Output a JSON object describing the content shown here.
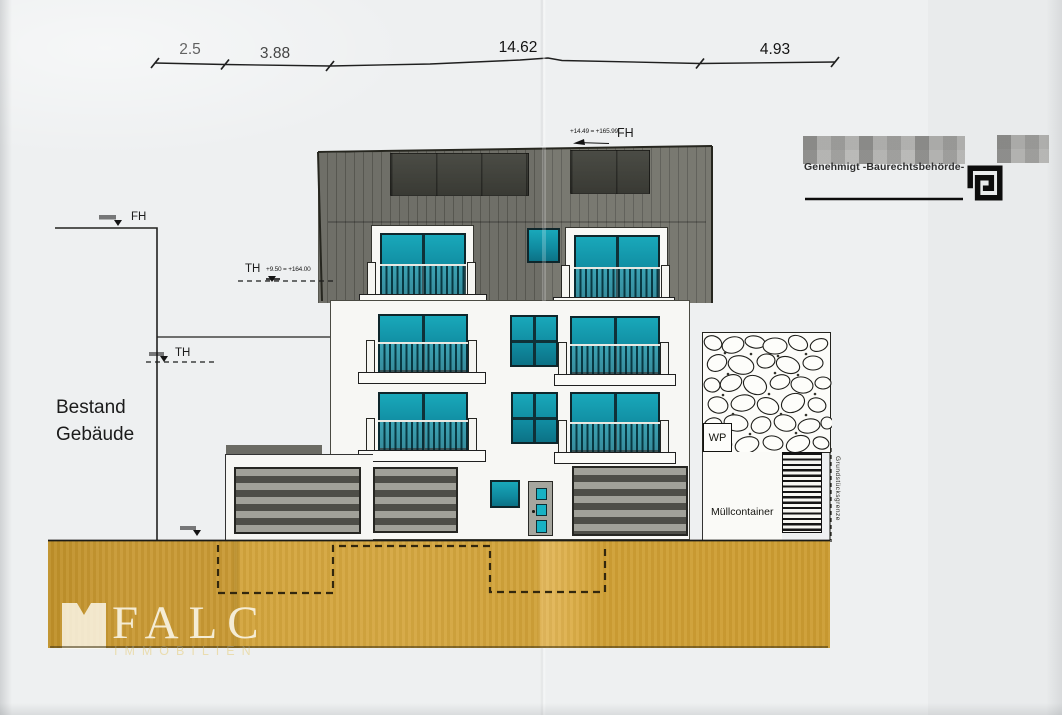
{
  "dims": [
    "2.5",
    "3.88",
    "14.62",
    "4.93"
  ],
  "levels": {
    "fh_roof": {
      "label": "FH",
      "value": "+14.49 = +165.99"
    },
    "th_upper": {
      "label": "TH",
      "value": "+9.50 = +164.00"
    },
    "fh_existing": {
      "label": "FH"
    },
    "th_existing": {
      "label": "TH"
    }
  },
  "labels": {
    "existing_building_line1": "Bestand",
    "existing_building_line2": "Gebäude",
    "wp": "WP",
    "muellcontainer": "Müllcontainer",
    "property_boundary": "Grundstücksgrenze",
    "approval": "Genehmigt -Baurechtsbehörde-"
  },
  "watermark": {
    "brand": "FALC",
    "subtitle": "IMMOBILIEN"
  },
  "colors": {
    "paper": "#eef0f1",
    "window_teal": "#129db0",
    "roof_gray": "#6f6f68",
    "solar_panel": "#41423b",
    "ground_gold": "#d2a33a",
    "garage_stripe_dark": "#4e4e48"
  }
}
